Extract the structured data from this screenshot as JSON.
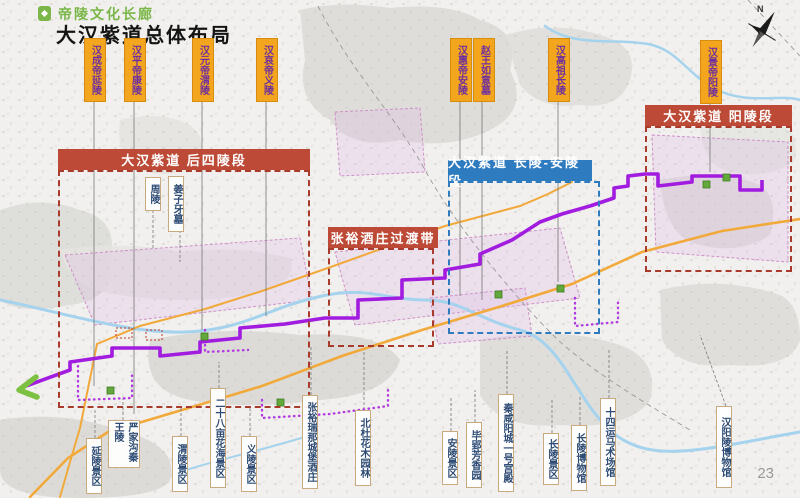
{
  "page": {
    "corridor_subtitle": "帝陵文化长廊",
    "title": "大汉紫道总体布局",
    "page_number": "23",
    "compass_label": "N"
  },
  "colors": {
    "title_green": "#7ab648",
    "tag_yellow": "#f2a51d",
    "tag_text_purple": "#6d2fa0",
    "section_red": "#bd4a36",
    "section_blue": "#2e7bc0",
    "route_purple": "#a21ce0",
    "route_arrow_green": "#7cc142",
    "road_orange": "#f2a93b",
    "river_blue": "#a5d3ee",
    "site_label_navy": "#2d4b74",
    "site_marker_green": "#62a83a"
  },
  "tomb_tags": [
    {
      "label": "汉成帝延陵"
    },
    {
      "label": "汉平帝康陵"
    },
    {
      "label": "汉元帝渭陵"
    },
    {
      "label": "汉哀帝义陵"
    },
    {
      "label": "汉惠帝安陵"
    },
    {
      "label": "赵王如意墓"
    },
    {
      "label": "汉高祖长陵"
    },
    {
      "label": "汉景帝阳陵"
    }
  ],
  "sections": [
    {
      "label": "大汉紫道 后四陵段",
      "style": "red"
    },
    {
      "label": "张裕酒庄过渡带",
      "style": "red"
    },
    {
      "label": "大汉紫道 长陵-安陵段",
      "style": "blue"
    },
    {
      "label": "大汉紫道 阳陵段",
      "style": "red"
    }
  ],
  "inner_site_labels": [
    {
      "label": "周陵"
    },
    {
      "label": "姜子牙墓"
    }
  ],
  "site_labels": [
    {
      "label": "延陵景区"
    },
    {
      "label": "严家沟秦王陵"
    },
    {
      "label": "渭陵景区"
    },
    {
      "label": "二十八亩花海景区"
    },
    {
      "label": "义陵景区"
    },
    {
      "label": "张裕瑞那城堡酒庄"
    },
    {
      "label": "北杜花木园林"
    },
    {
      "label": "安陵景区"
    },
    {
      "label": "毕郢芳香园"
    },
    {
      "label": "秦咸阳城一号宫殿"
    },
    {
      "label": "长陵景区"
    },
    {
      "label": "长陵博物馆"
    },
    {
      "label": "十四运马术场馆"
    },
    {
      "label": "汉阳陵博物馆"
    }
  ]
}
